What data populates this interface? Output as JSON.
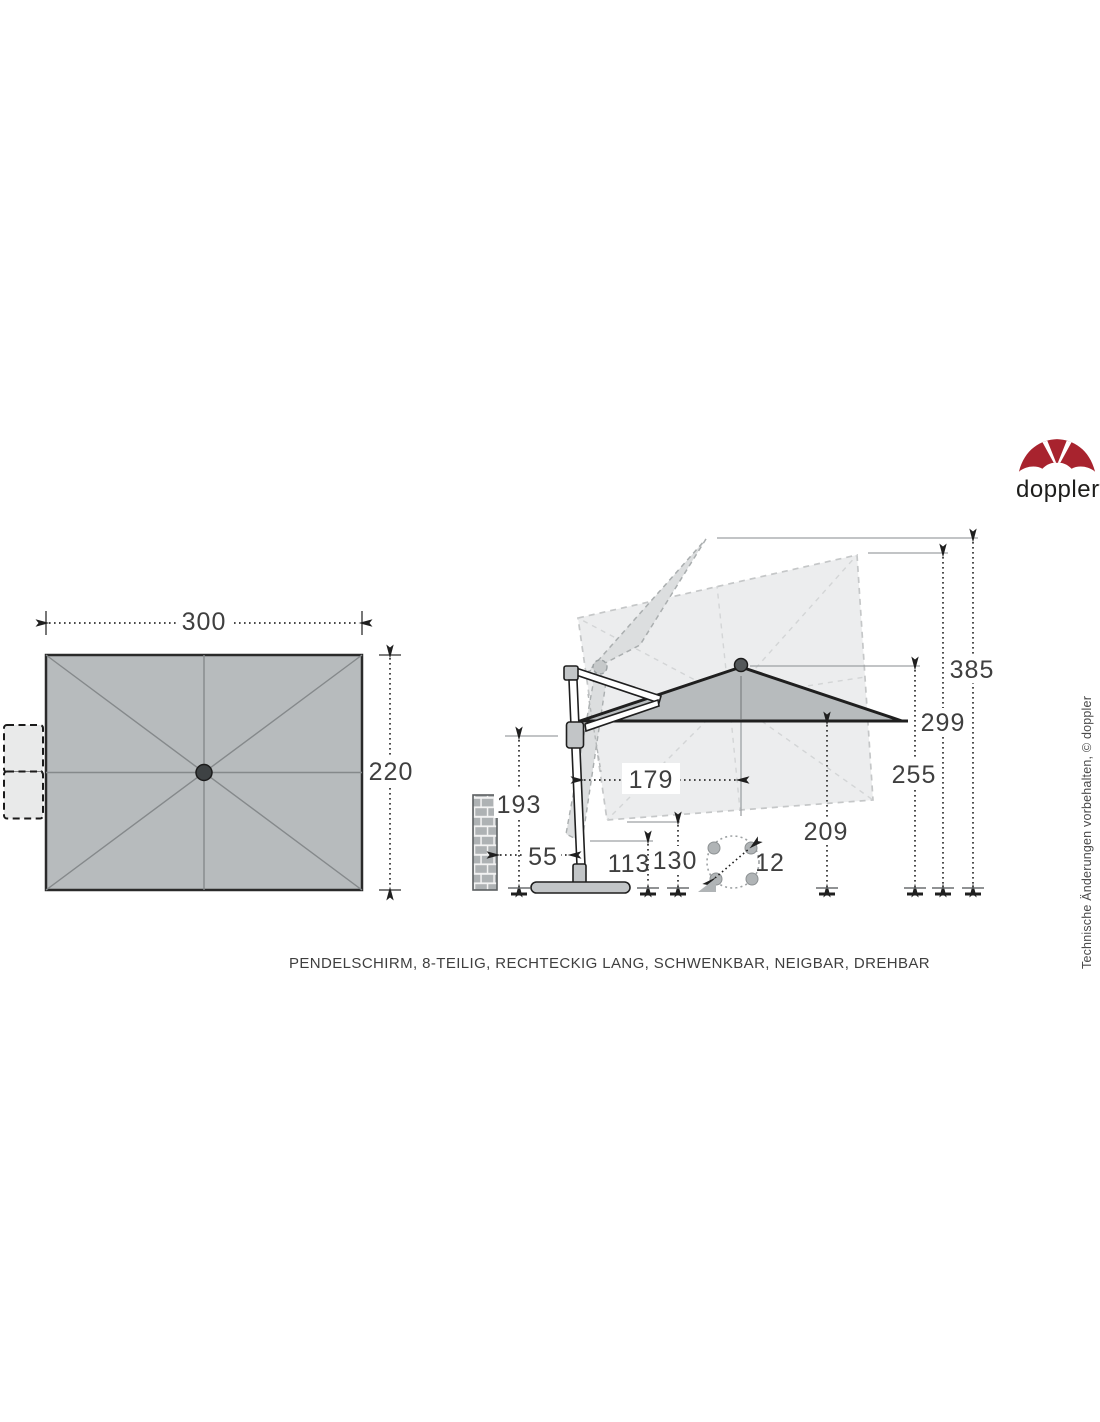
{
  "header": {
    "logo_brand": "doppler",
    "logo_registered": "®"
  },
  "caption": "PENDELSCHIRM, 8-TEILIG, RECHTECKIG LANG, SCHWENKBAR, NEIGBAR, DREHBAR",
  "side_note": "Technische Änderungen vorbehalten, © doppler",
  "colors": {
    "brand_red": "#a8232e",
    "canopy_gray": "#b7bbbd",
    "ghost_gray": "#ecedee",
    "line_dark": "#1f1f1f",
    "dim_text": "#3f3f3f"
  },
  "dimensions": {
    "canopy_width": "300",
    "canopy_depth": "220",
    "max_height": "385",
    "hub_height": "299",
    "canopy_edge_height": "255",
    "clearance_height": "209",
    "arm_joint_height": "193",
    "side_offset": "179",
    "tilted_clearance": "130",
    "low_clearance": "113",
    "wall_distance": "55",
    "base_size": "12"
  }
}
